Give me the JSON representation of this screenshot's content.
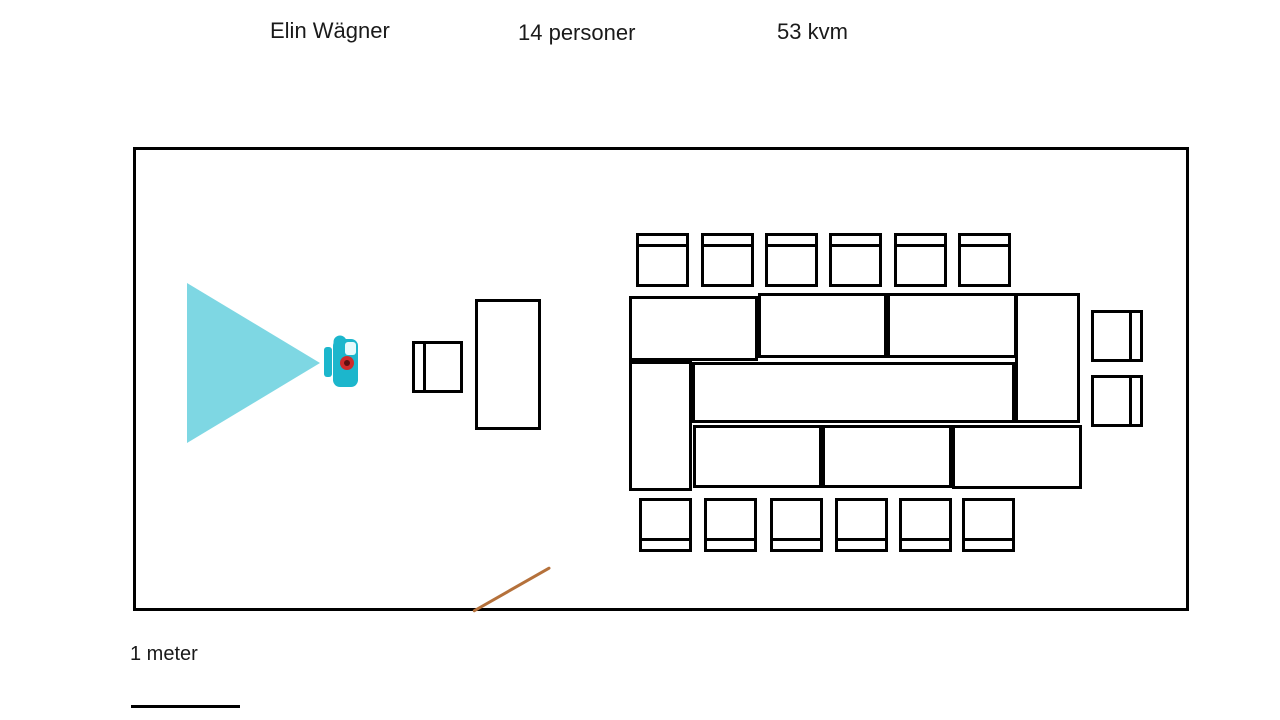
{
  "header": {
    "room_name": "Elin Wägner",
    "capacity_label": "14 personer",
    "area_label": "53 kvm"
  },
  "scale": {
    "label": "1 meter"
  },
  "colors": {
    "wall": "#000000",
    "beam": "#7ed7e3",
    "projector_body": "#1cb6cc",
    "projector_lens": "#cf2b2b",
    "projector_lens_center": "#5d1111",
    "projector_notch": "#e6fafc",
    "door_swing": "#b5713b"
  },
  "floor_plan": {
    "room": {
      "x": 133,
      "y": 147,
      "w": 1056,
      "h": 464
    },
    "projector_beam": {
      "x": 187,
      "y": 283,
      "w": 133,
      "h": 160
    },
    "projector_device": {
      "x": 320,
      "y": 333,
      "w": 40,
      "h": 58
    },
    "lectern": {
      "x": 475,
      "y": 299,
      "w": 66,
      "h": 131
    },
    "table_modules": [
      {
        "x": 629,
        "y": 296,
        "w": 129,
        "h": 65
      },
      {
        "x": 758,
        "y": 293,
        "w": 129,
        "h": 65
      },
      {
        "x": 887,
        "y": 293,
        "w": 130,
        "h": 65
      },
      {
        "x": 1015,
        "y": 293,
        "w": 65,
        "h": 130
      },
      {
        "x": 692,
        "y": 362,
        "w": 323,
        "h": 61
      },
      {
        "x": 629,
        "y": 361,
        "w": 63,
        "h": 130
      },
      {
        "x": 693,
        "y": 425,
        "w": 129,
        "h": 63
      },
      {
        "x": 822,
        "y": 425,
        "w": 130,
        "h": 63
      },
      {
        "x": 952,
        "y": 425,
        "w": 130,
        "h": 64
      }
    ],
    "chairs": [
      {
        "x": 412,
        "y": 341,
        "w": 51,
        "h": 52,
        "back": "left"
      },
      {
        "x": 636,
        "y": 233,
        "w": 53,
        "h": 54,
        "back": "top"
      },
      {
        "x": 701,
        "y": 233,
        "w": 53,
        "h": 54,
        "back": "top"
      },
      {
        "x": 765,
        "y": 233,
        "w": 53,
        "h": 54,
        "back": "top"
      },
      {
        "x": 829,
        "y": 233,
        "w": 53,
        "h": 54,
        "back": "top"
      },
      {
        "x": 894,
        "y": 233,
        "w": 53,
        "h": 54,
        "back": "top"
      },
      {
        "x": 958,
        "y": 233,
        "w": 53,
        "h": 54,
        "back": "top"
      },
      {
        "x": 639,
        "y": 498,
        "w": 53,
        "h": 54,
        "back": "bottom"
      },
      {
        "x": 704,
        "y": 498,
        "w": 53,
        "h": 54,
        "back": "bottom"
      },
      {
        "x": 770,
        "y": 498,
        "w": 53,
        "h": 54,
        "back": "bottom"
      },
      {
        "x": 835,
        "y": 498,
        "w": 53,
        "h": 54,
        "back": "bottom"
      },
      {
        "x": 899,
        "y": 498,
        "w": 53,
        "h": 54,
        "back": "bottom"
      },
      {
        "x": 962,
        "y": 498,
        "w": 53,
        "h": 54,
        "back": "bottom"
      },
      {
        "x": 1091,
        "y": 310,
        "w": 52,
        "h": 52,
        "back": "right"
      },
      {
        "x": 1091,
        "y": 375,
        "w": 52,
        "h": 52,
        "back": "right"
      }
    ],
    "door_swing": {
      "x": 473,
      "y": 610,
      "length": 89,
      "angle_deg": -29.7
    },
    "scale_bar": {
      "x": 131,
      "y": 705,
      "w": 109,
      "h": 3
    }
  }
}
